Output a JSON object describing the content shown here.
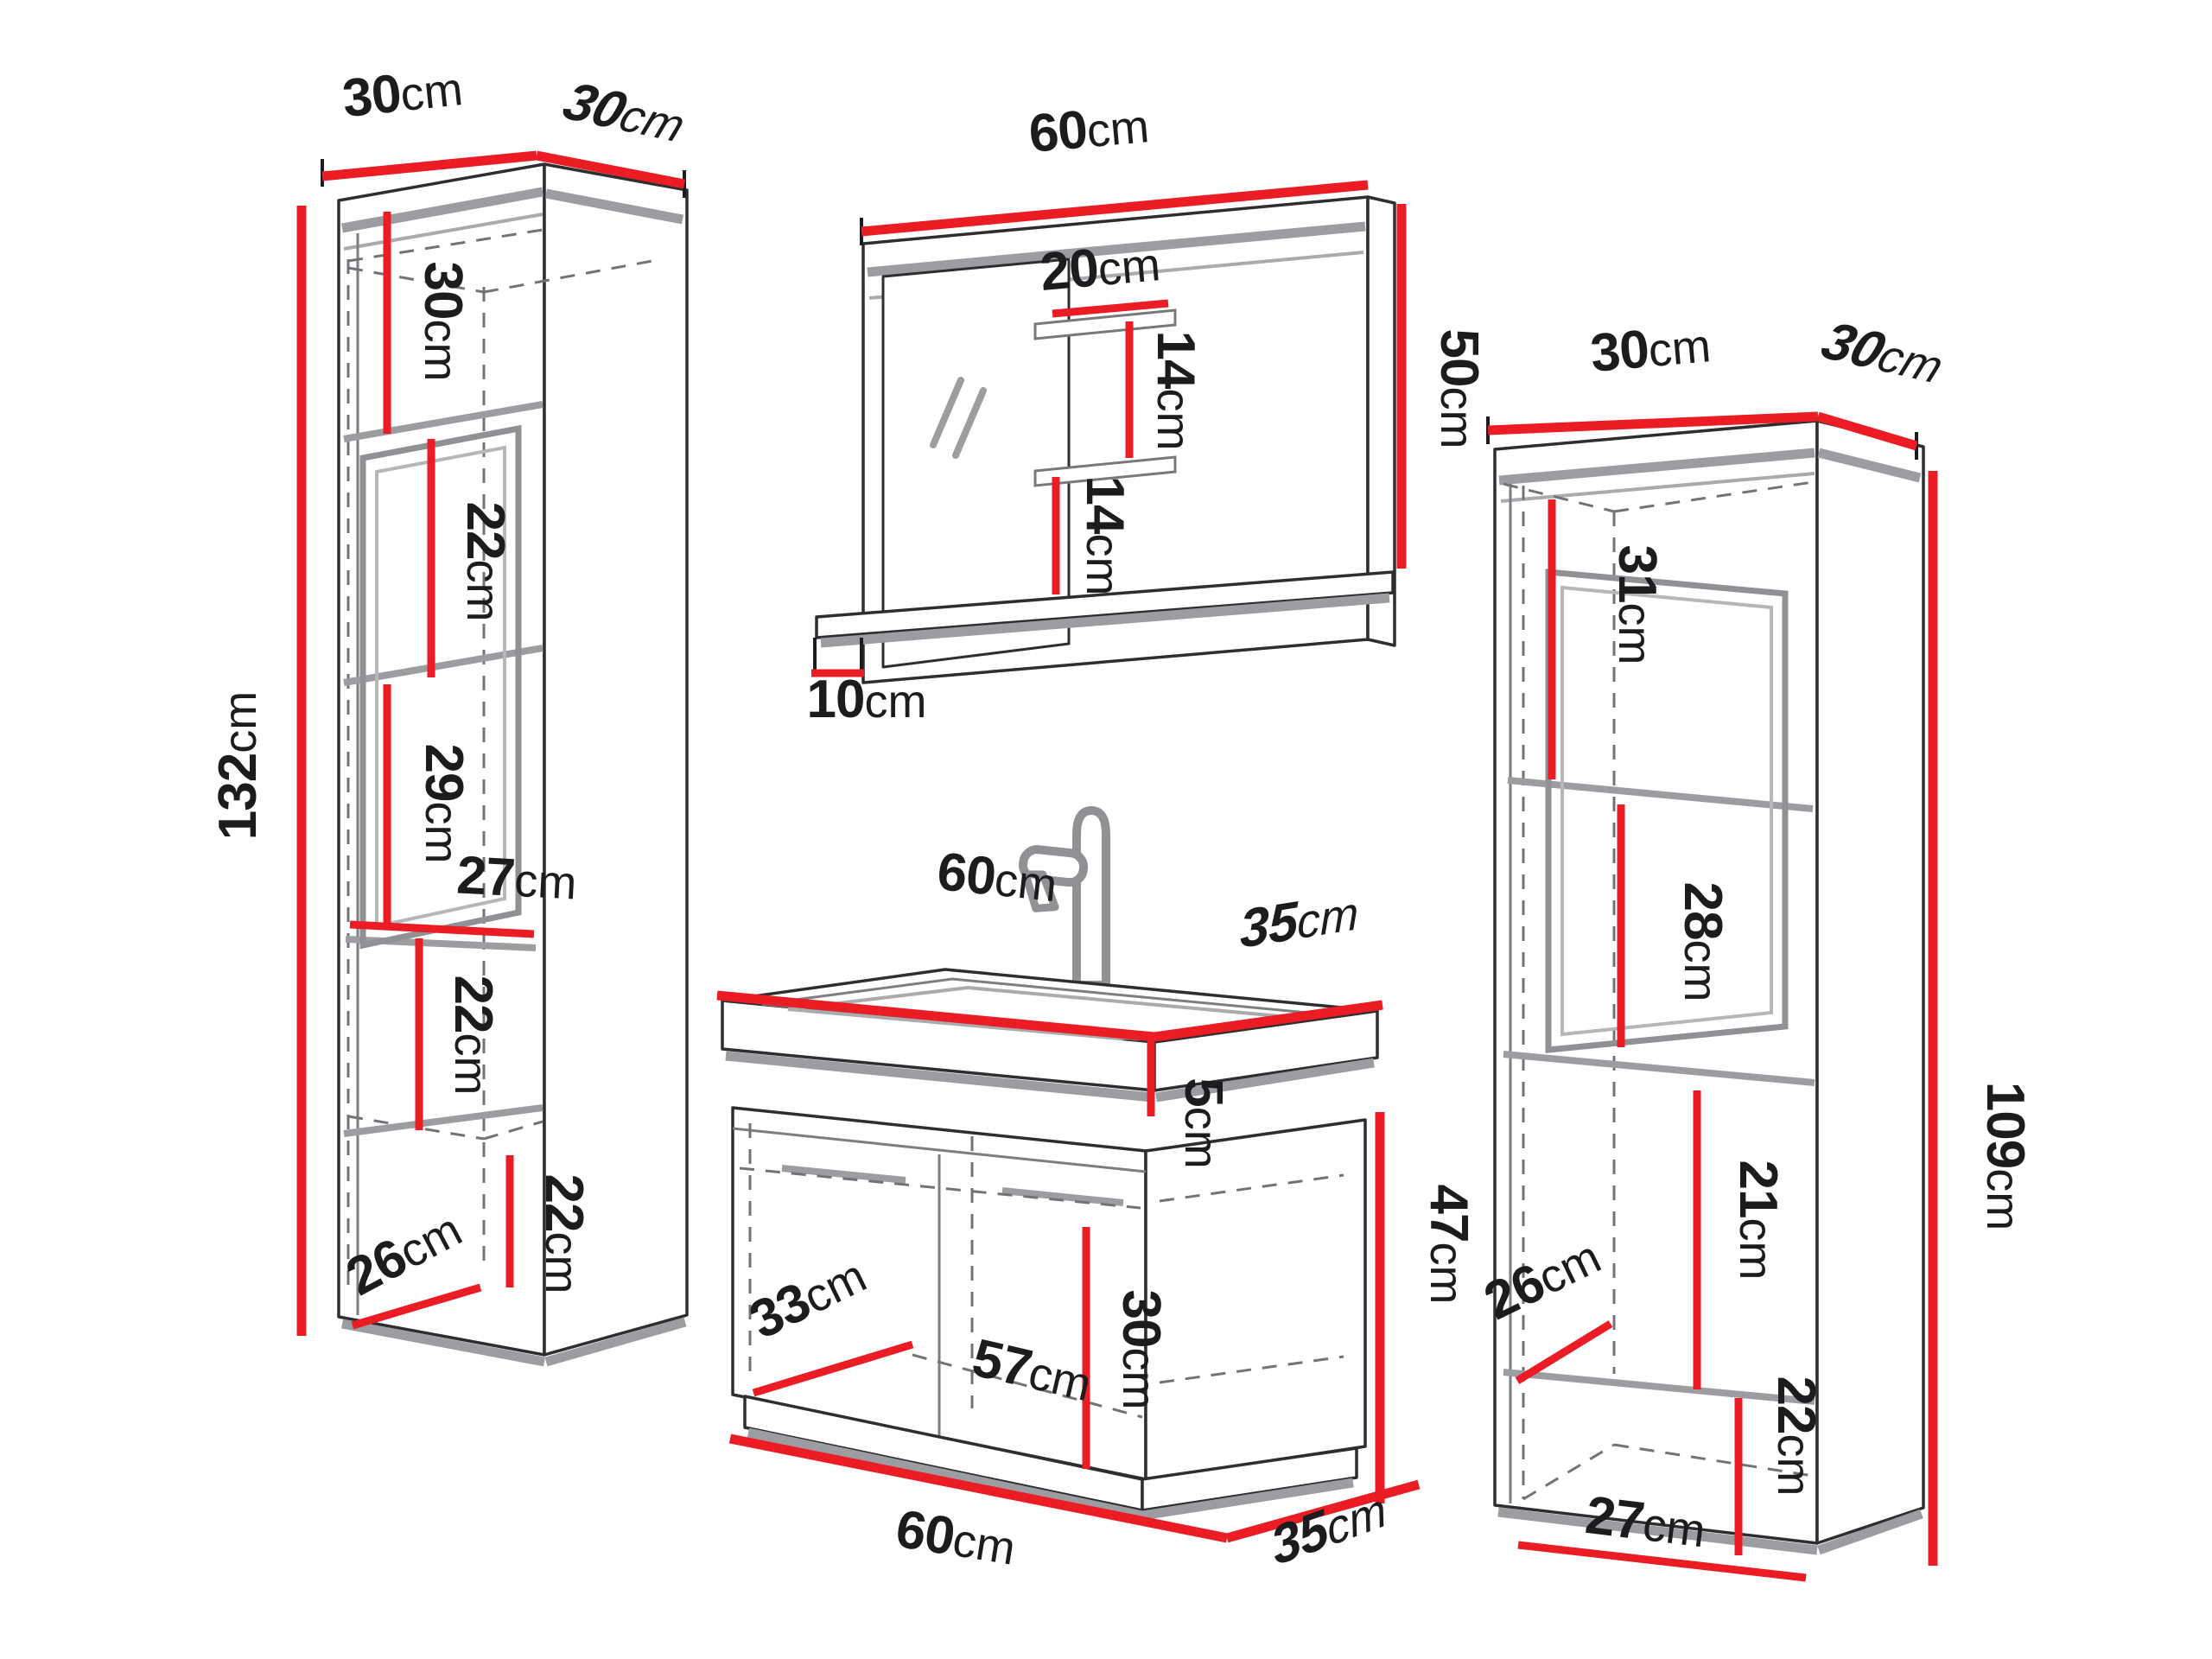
{
  "title": "Bathroom furniture set dimensions diagram",
  "units": {
    "cm": "cm"
  },
  "colors": {
    "dimension_red": "#ec1c24",
    "outline_black": "#2e2e30",
    "shadow_gray": "#9b9da0",
    "background": "#ffffff"
  },
  "furniture": {
    "left_cabinet": {
      "name": "tall cabinet 132cm",
      "top_width": {
        "n": "30"
      },
      "top_depth": {
        "n": "30"
      },
      "height": {
        "n": "132"
      },
      "gap_1": {
        "n": "30"
      },
      "gap_2": {
        "n": "22"
      },
      "gap_3": {
        "n": "29"
      },
      "inner_width": {
        "n": "27"
      },
      "gap_4": {
        "n": "22"
      },
      "gap_5": {
        "n": "22"
      },
      "inner_depth": {
        "n": "26"
      }
    },
    "mirror": {
      "name": "mirror with shelves 60x50cm",
      "width": {
        "n": "60"
      },
      "shelf_width": {
        "n": "20"
      },
      "gap_top": {
        "n": "14"
      },
      "gap_bottom": {
        "n": "14"
      },
      "height": {
        "n": "50"
      },
      "shelf_depth": {
        "n": "10"
      }
    },
    "washbasin_cabinet": {
      "name": "washbasin cabinet 60x35x47cm",
      "top_width": {
        "n": "60"
      },
      "top_depth": {
        "n": "35"
      },
      "basin_height": {
        "n": "5"
      },
      "height": {
        "n": "47"
      },
      "door_gap": {
        "n": "30"
      },
      "inner_depth": {
        "n": "33"
      },
      "inner_width": {
        "n": "57"
      },
      "bottom_width": {
        "n": "60"
      },
      "bottom_depth": {
        "n": "35"
      }
    },
    "right_cabinet": {
      "name": "tall cabinet 109cm",
      "top_width": {
        "n": "30"
      },
      "top_depth": {
        "n": "30"
      },
      "height": {
        "n": "109"
      },
      "gap_1": {
        "n": "31"
      },
      "gap_2": {
        "n": "28"
      },
      "inner_depth": {
        "n": "26"
      },
      "gap_3": {
        "n": "21"
      },
      "gap_4": {
        "n": "22"
      },
      "inner_width": {
        "n": "27"
      }
    }
  }
}
